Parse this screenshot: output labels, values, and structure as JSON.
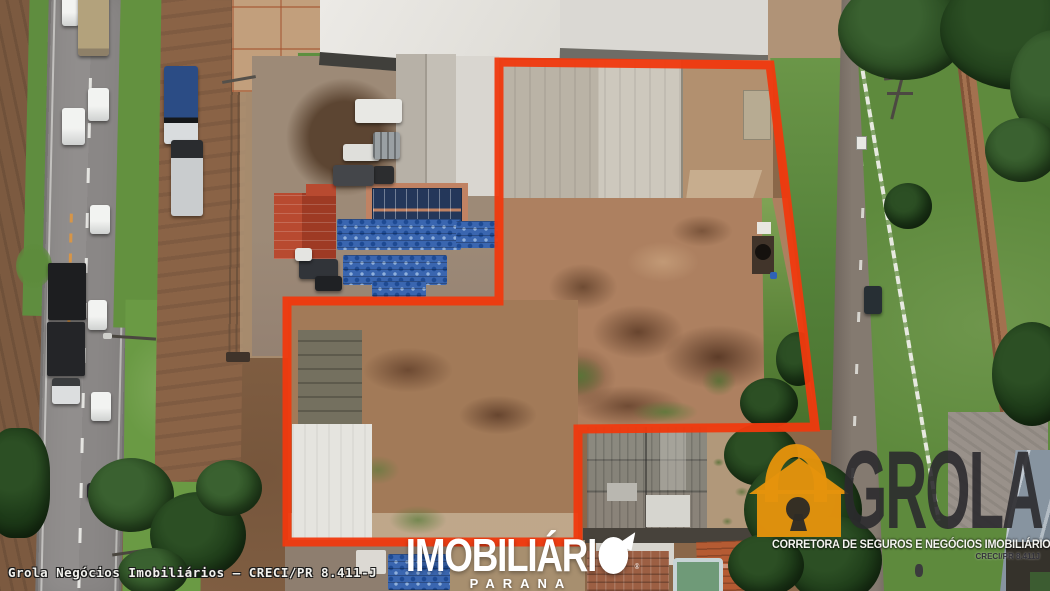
{
  "image_type": "aerial-drone-photo-real-estate",
  "colors": {
    "boundary_red": "#F0390E",
    "grola_orange": "#E5930C",
    "grola_text": "#2B2A2E",
    "watermark_white": "#FFFFFF"
  },
  "boundary": {
    "color": "#F0390E",
    "polygon_points": "499,62 770,65 815,427 578,429 578,542 287,542 287,301 499,301"
  },
  "watermarks": {
    "caption_bottom_left": "Grola Negócios Imobiliários — CRECI/PR 8.411-J",
    "grola": {
      "name": "GROLA",
      "tagline": "CORRETORA DE SEGUROS E NEGÓCIOS IMOBILIÁRIOS",
      "creci": "CRECI/PR 8.411J",
      "icon": "lock-house-icon"
    },
    "imobiliario": {
      "name": "IMOBILIÁRIO",
      "display_prefix": "IMOBILIÁRI",
      "region": "PARANA",
      "registered_mark": "®",
      "icon": "disc-flag-icon"
    }
  }
}
